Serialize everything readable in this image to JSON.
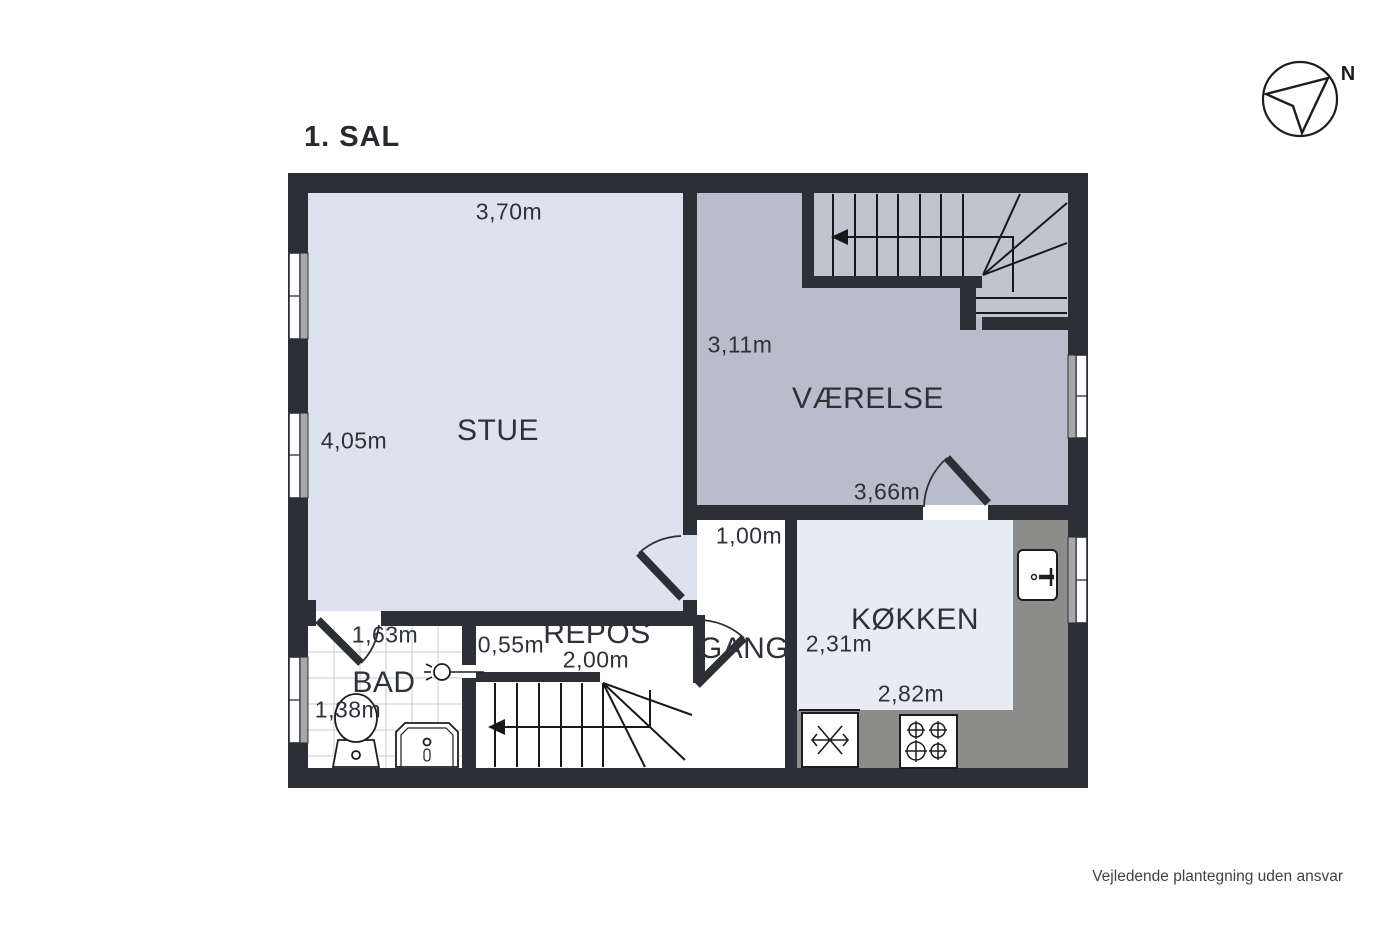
{
  "title": "1. SAL",
  "compass": {
    "north_label": "N"
  },
  "footer": {
    "disclaimer": "Vejledende plantegning uden ansvar"
  },
  "rooms": {
    "stue": {
      "name": "STUE",
      "dim_top": "3,70m",
      "dim_left": "4,05m"
    },
    "vaerelse": {
      "name": "VÆRELSE",
      "dim_left": "3,11m",
      "dim_bottom": "3,66m"
    },
    "koekken": {
      "name": "KØKKEN",
      "dim_left": "2,31m",
      "dim_bottom": "2,82m"
    },
    "gang": {
      "name": "GANG",
      "dim_top": "1,00m"
    },
    "repos": {
      "name": "REPOS",
      "dim_left": "0,55m",
      "dim_bottom": "2,00m"
    },
    "bad": {
      "name": "BAD",
      "dim_top": "1,63m",
      "dim_left": "1,38m"
    }
  },
  "colors": {
    "wall": "#2c3036",
    "stue_floor": "#dce3ee",
    "vaerelse_floor": "#b7bdca",
    "stairs_floor": "#bfc4cf",
    "koekken_floor": "#e7ecf3",
    "counter": "#8c8c8a",
    "text": "#2e3238"
  }
}
